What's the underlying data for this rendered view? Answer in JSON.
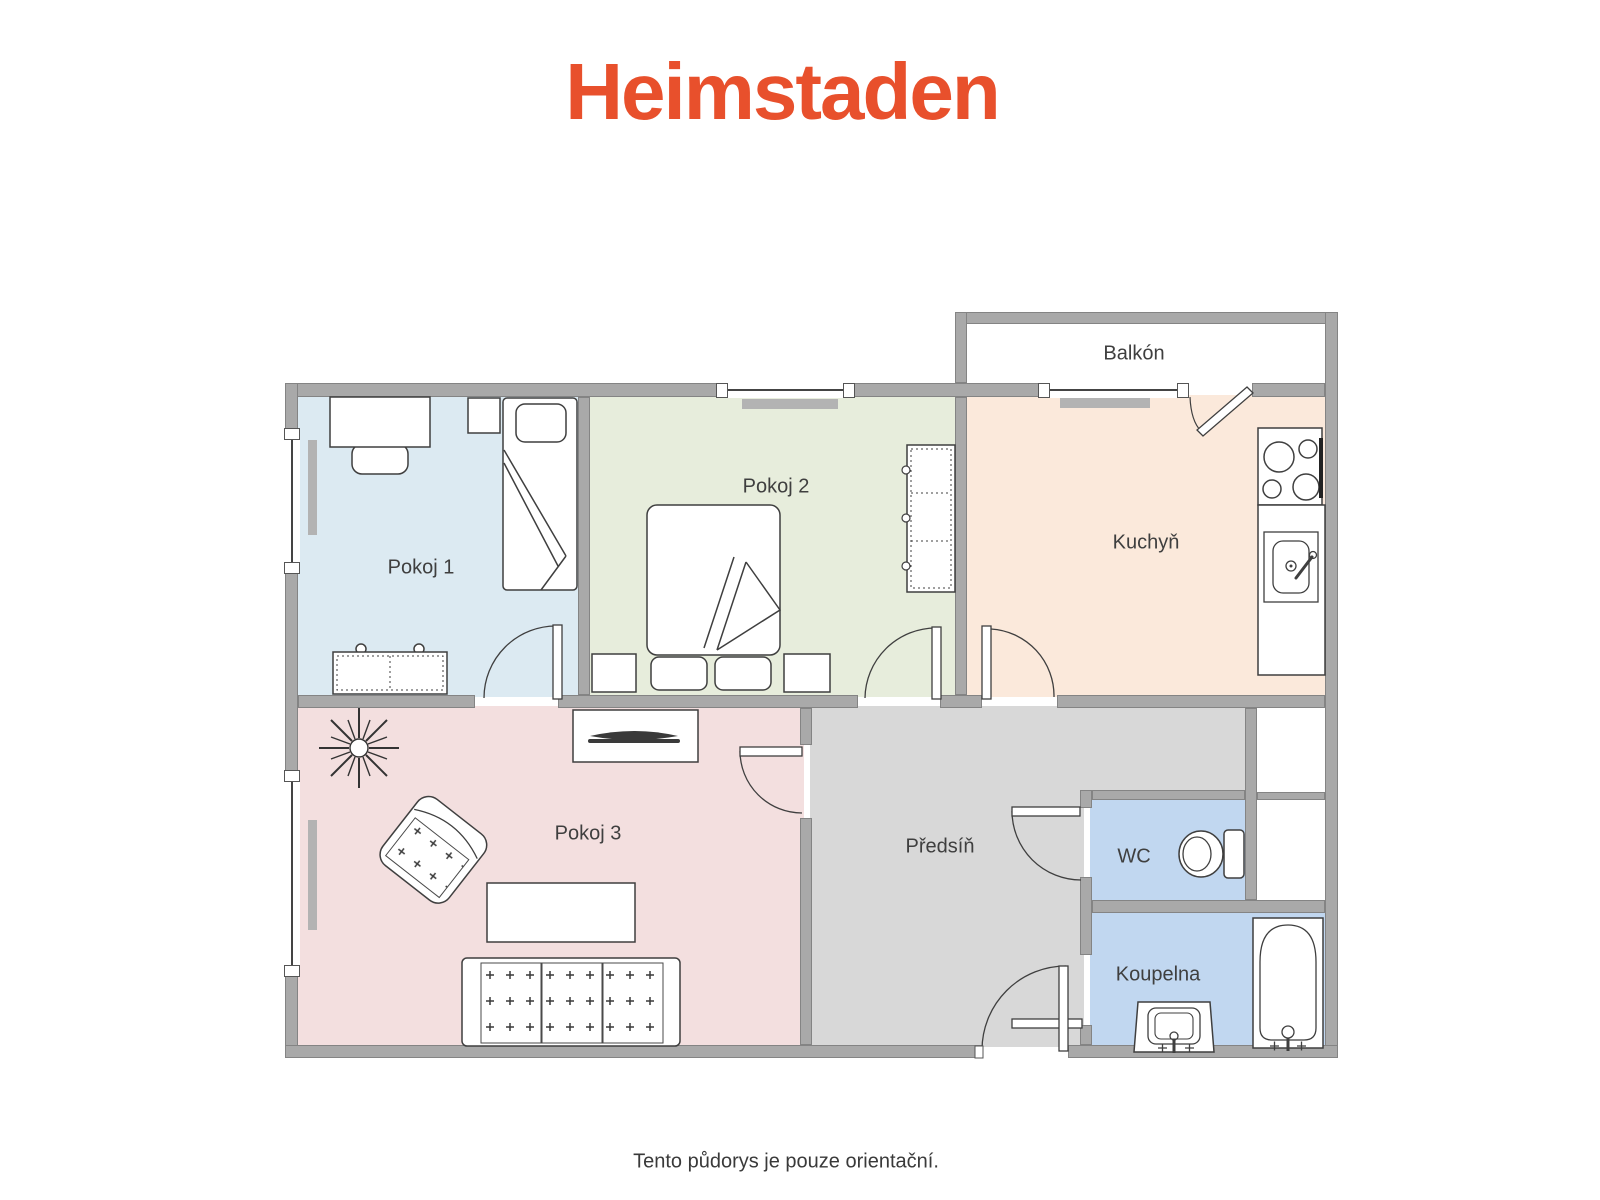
{
  "header": {
    "logo": "Heimstaden"
  },
  "footer": {
    "disclaimer": "Tento půdorys je pouze orientační."
  },
  "floorplan": {
    "rooms": [
      {
        "id": "pokoj1",
        "label": "Pokoj 1",
        "fill": "#dcEAF2"
      },
      {
        "id": "pokoj2",
        "label": "Pokoj 2",
        "fill": "#e7eddc"
      },
      {
        "id": "kuchyn",
        "label": "Kuchyň",
        "fill": "#fbe9db"
      },
      {
        "id": "balkon",
        "label": "Balkón",
        "fill": "#ffffff"
      },
      {
        "id": "pokoj3",
        "label": "Pokoj 3",
        "fill": "#f3dfdf"
      },
      {
        "id": "predsin",
        "label": "Předsíň",
        "fill": "#d8d8d8"
      },
      {
        "id": "wc",
        "label": "WC",
        "fill": "#c1d7f0"
      },
      {
        "id": "koupelna",
        "label": "Koupelna",
        "fill": "#c1d7f0"
      }
    ],
    "colors": {
      "brand": "#e8502c",
      "wall": "#a9a9a9",
      "outline": "#3f3f3f",
      "radiator": "#b3b3b3",
      "text": "#3a3a3a"
    }
  }
}
